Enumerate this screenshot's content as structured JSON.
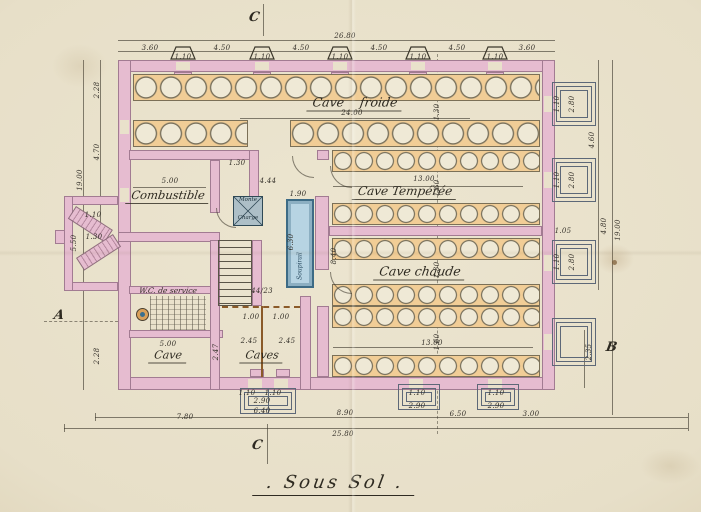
{
  "title": ". Sous Sol .",
  "rooms": {
    "cave_froide": "Cave    froide",
    "cave_temperee": "Cave Tempérée",
    "cave_chaude": "Cave chaude",
    "combustible": "Combustible",
    "wc": "W.C. de service",
    "cave": "Cave",
    "caves": "Caves",
    "monte_top": "Monte",
    "monte_bottom": "Charge",
    "shaft": "Soupirail"
  },
  "markers": {
    "left": "A",
    "right": "B",
    "bottom": "C",
    "top": "C"
  },
  "colors": {
    "paper": "#e7dfc8",
    "wall_pink": "#e6bcd0",
    "bin_orange": "#f1cd96",
    "shaft_blue": "#b7d4e3",
    "well_gray": "#5d6878",
    "ink": "#3c382c"
  },
  "dimensions": [
    {
      "t": "26.80",
      "x": 345,
      "y": 36
    },
    {
      "t": "3.60",
      "x": 150,
      "y": 48
    },
    {
      "t": "4.50",
      "x": 222,
      "y": 48
    },
    {
      "t": "4.50",
      "x": 301,
      "y": 48
    },
    {
      "t": "4.50",
      "x": 379,
      "y": 48
    },
    {
      "t": "4.50",
      "x": 457,
      "y": 48
    },
    {
      "t": "3.60",
      "x": 527,
      "y": 48
    },
    {
      "t": "1.10",
      "x": 183,
      "y": 57
    },
    {
      "t": "1.10",
      "x": 262,
      "y": 57
    },
    {
      "t": "1.10",
      "x": 340,
      "y": 57
    },
    {
      "t": "1.10",
      "x": 418,
      "y": 57
    },
    {
      "t": "1.10",
      "x": 495,
      "y": 57
    },
    {
      "t": "2.28",
      "x": 97,
      "y": 90,
      "r": 1
    },
    {
      "t": "4.70",
      "x": 97,
      "y": 152,
      "r": 1
    },
    {
      "t": "19.00",
      "x": 80,
      "y": 180,
      "r": 1
    },
    {
      "t": "5.50",
      "x": 74,
      "y": 243,
      "r": 1
    },
    {
      "t": "1.30",
      "x": 94,
      "y": 237
    },
    {
      "t": "1.10",
      "x": 93,
      "y": 215
    },
    {
      "t": "2.28",
      "x": 97,
      "y": 356,
      "r": 1
    },
    {
      "t": "4.60",
      "x": 592,
      "y": 140,
      "r": 1
    },
    {
      "t": "4.80",
      "x": 604,
      "y": 226,
      "r": 1
    },
    {
      "t": "19.00",
      "x": 618,
      "y": 230,
      "r": 1
    },
    {
      "t": "2.80",
      "x": 572,
      "y": 104,
      "r": 1
    },
    {
      "t": "2.80",
      "x": 572,
      "y": 180,
      "r": 1
    },
    {
      "t": "2.80",
      "x": 572,
      "y": 262,
      "r": 1
    },
    {
      "t": "1.10",
      "x": 557,
      "y": 104,
      "r": 1
    },
    {
      "t": "1.10",
      "x": 557,
      "y": 180,
      "r": 1
    },
    {
      "t": "1.10",
      "x": 557,
      "y": 262,
      "r": 1
    },
    {
      "t": "1.05",
      "x": 563,
      "y": 231
    },
    {
      "t": "2.35",
      "x": 589,
      "y": 352,
      "r": 1
    },
    {
      "t": "24.00",
      "x": 352,
      "y": 113
    },
    {
      "t": "13.00",
      "x": 424,
      "y": 179
    },
    {
      "t": "13.00",
      "x": 432,
      "y": 343
    },
    {
      "t": "5.00",
      "x": 170,
      "y": 181
    },
    {
      "t": "4.44",
      "x": 268,
      "y": 181
    },
    {
      "t": "1.30",
      "x": 237,
      "y": 163
    },
    {
      "t": "1.90",
      "x": 298,
      "y": 194
    },
    {
      "t": "6.30",
      "x": 291,
      "y": 242,
      "r": 1
    },
    {
      "t": "8.40",
      "x": 334,
      "y": 256,
      "r": 1
    },
    {
      "t": "1.30",
      "x": 437,
      "y": 112,
      "r": 1
    },
    {
      "t": "1.60",
      "x": 437,
      "y": 188,
      "r": 1
    },
    {
      "t": "1.30",
      "x": 437,
      "y": 270,
      "r": 1
    },
    {
      "t": "1.60",
      "x": 437,
      "y": 342,
      "r": 1
    },
    {
      "t": "44/23",
      "x": 262,
      "y": 291
    },
    {
      "t": "5.00",
      "x": 168,
      "y": 344
    },
    {
      "t": "2.47",
      "x": 216,
      "y": 352,
      "r": 1
    },
    {
      "t": "1.00",
      "x": 251,
      "y": 317
    },
    {
      "t": "1.00",
      "x": 281,
      "y": 317
    },
    {
      "t": "2.45",
      "x": 249,
      "y": 341
    },
    {
      "t": "2.45",
      "x": 287,
      "y": 341
    },
    {
      "t": "1.10",
      "x": 247,
      "y": 393
    },
    {
      "t": "1.10",
      "x": 273,
      "y": 393
    },
    {
      "t": "2.90",
      "x": 262,
      "y": 401
    },
    {
      "t": "6.40",
      "x": 262,
      "y": 411
    },
    {
      "t": "7.80",
      "x": 185,
      "y": 417
    },
    {
      "t": "8.90",
      "x": 345,
      "y": 413
    },
    {
      "t": "25.80",
      "x": 343,
      "y": 434
    },
    {
      "t": "1.10",
      "x": 417,
      "y": 393
    },
    {
      "t": "1.10",
      "x": 496,
      "y": 393
    },
    {
      "t": "2.90",
      "x": 417,
      "y": 406
    },
    {
      "t": "2.90",
      "x": 496,
      "y": 406
    },
    {
      "t": "6.50",
      "x": 458,
      "y": 414
    },
    {
      "t": "3.00",
      "x": 531,
      "y": 414
    }
  ]
}
